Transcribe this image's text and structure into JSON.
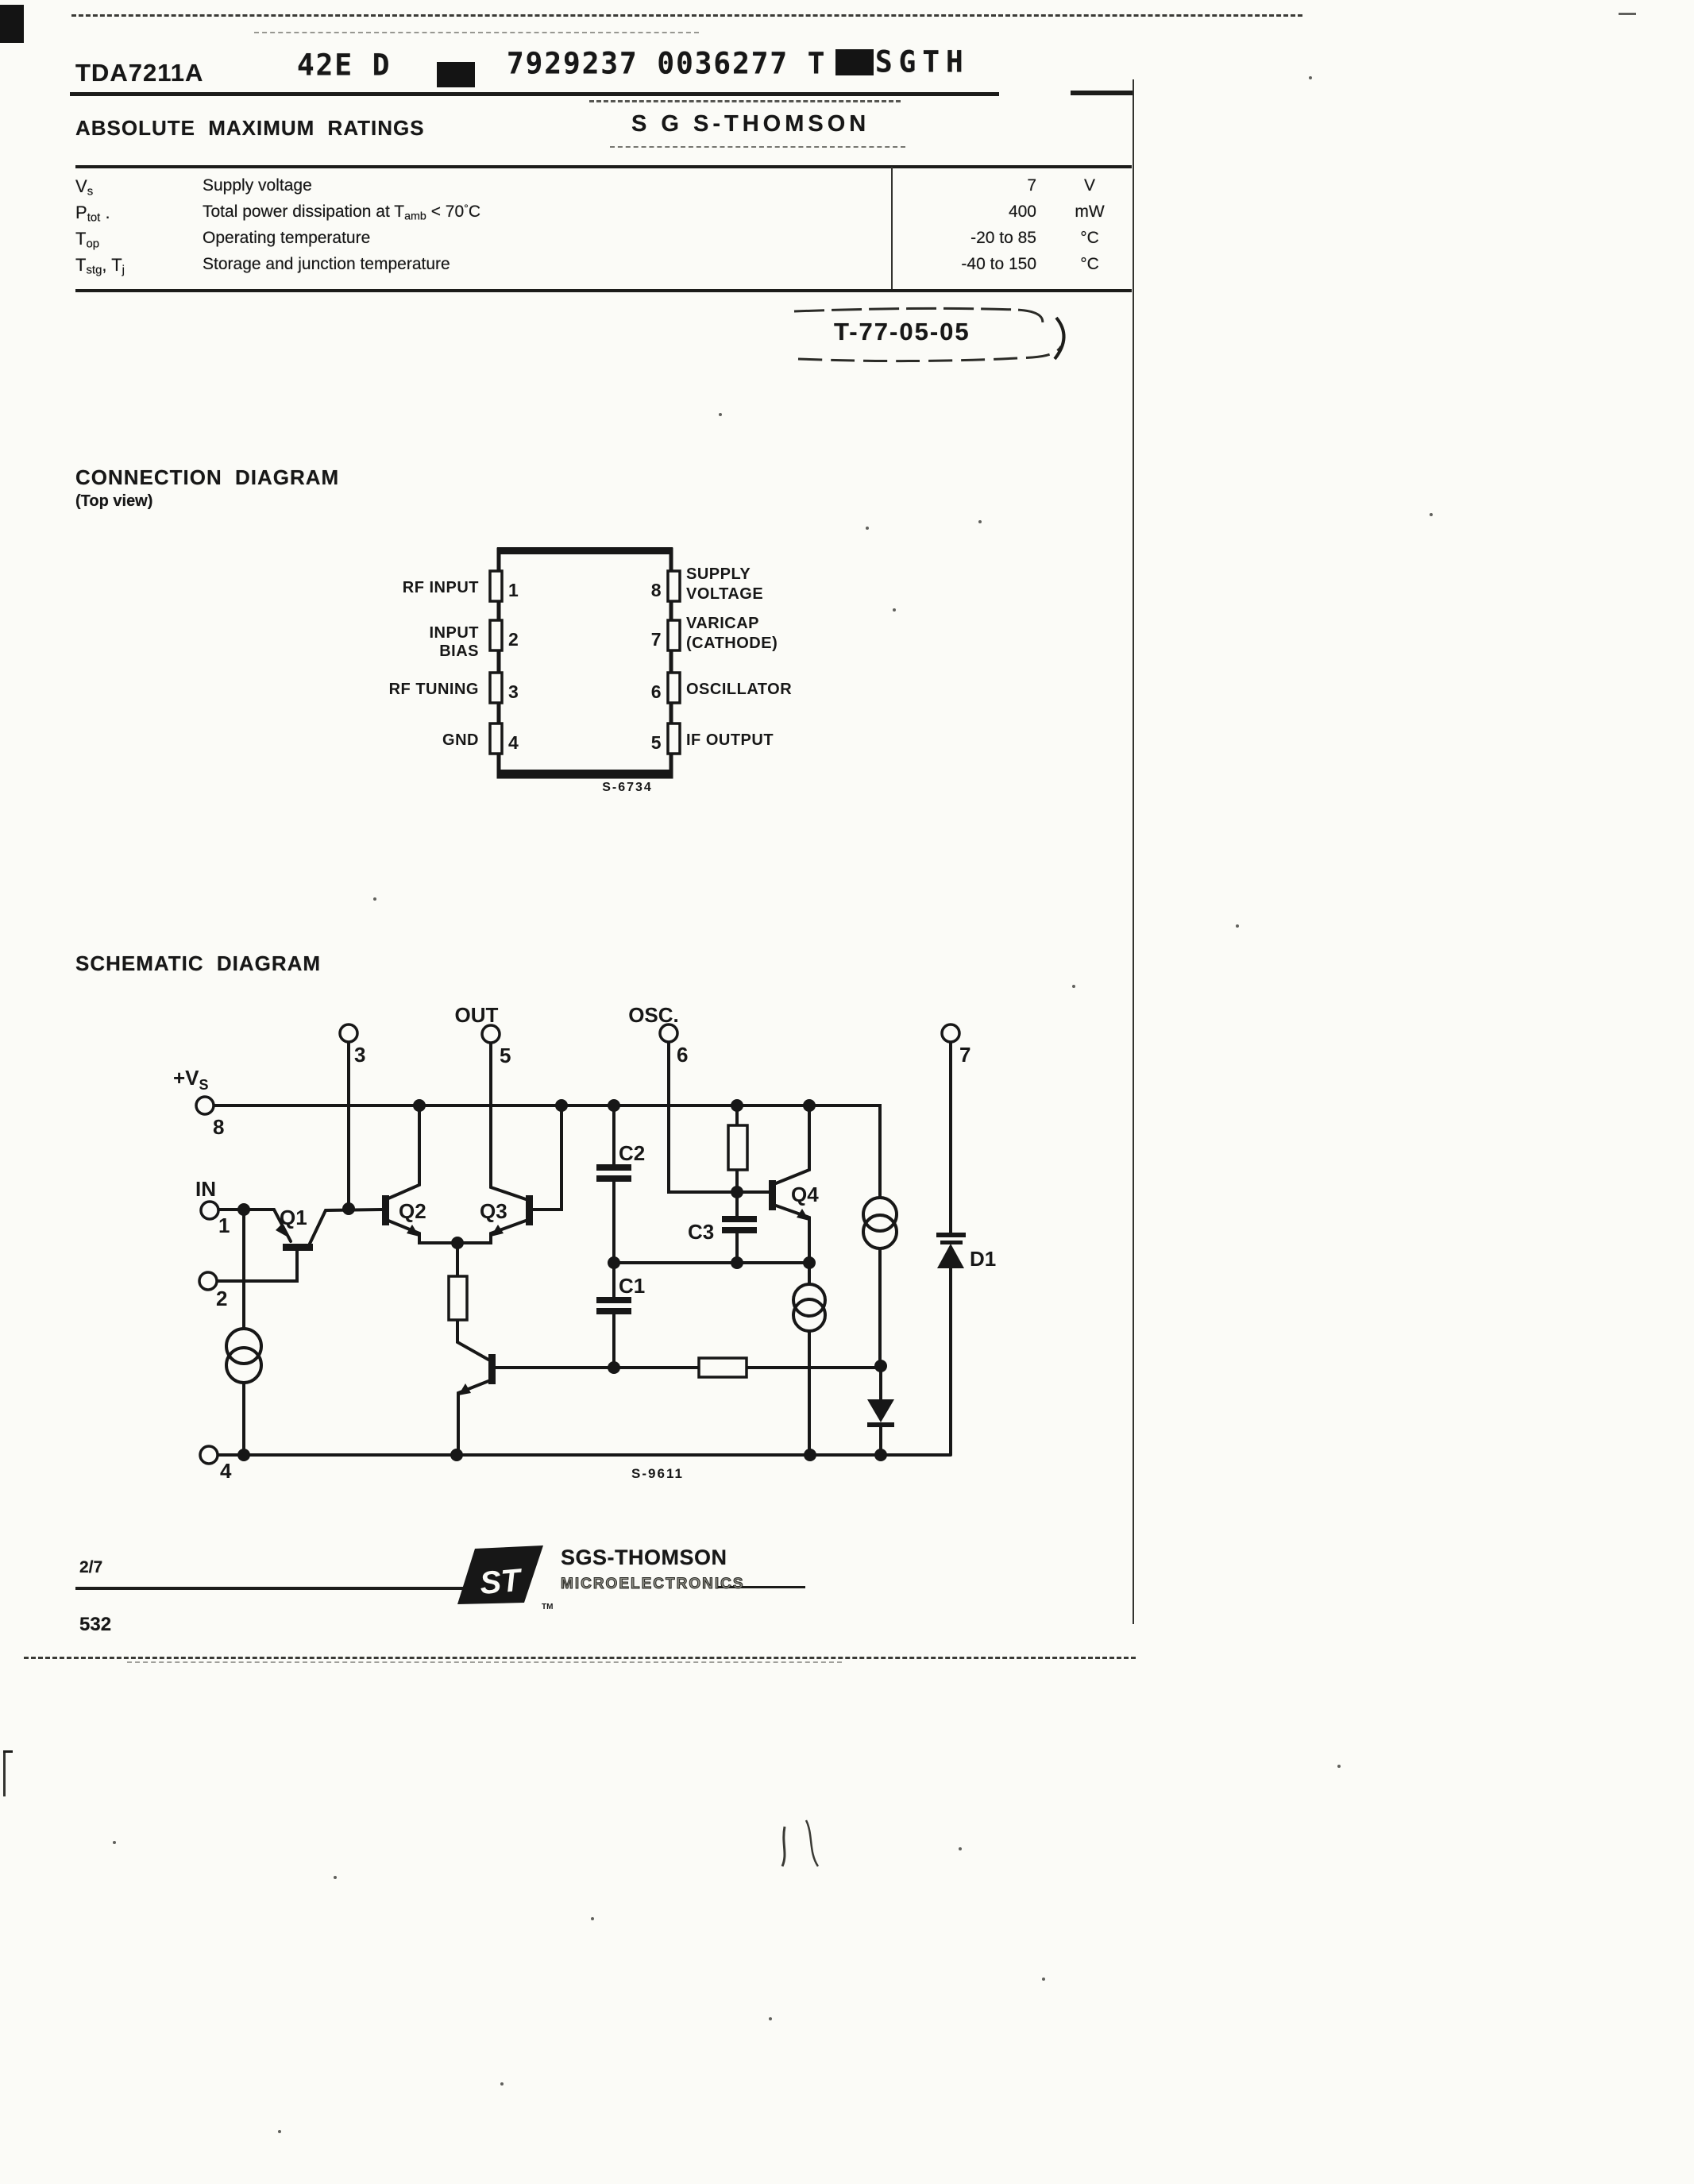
{
  "header": {
    "part": "TDA7211A",
    "code": "42E D",
    "serial": "7929237 0036277 T",
    "suffix": "SGTH"
  },
  "stamps": {
    "sgs": "S G S-THOMSON",
    "t77": "T-77-05-05"
  },
  "ratings": {
    "title": "ABSOLUTE MAXIMUM RATINGS",
    "rows": [
      {
        "sym": [
          {
            "t": "V"
          },
          {
            "t": "s",
            "sub": true
          }
        ],
        "desc": [
          {
            "t": "Supply voltage"
          }
        ],
        "value": "7",
        "unit": "V"
      },
      {
        "sym": [
          {
            "t": "P"
          },
          {
            "t": "tot",
            "sub": true
          },
          {
            "t": " ."
          }
        ],
        "desc": [
          {
            "t": "Total power dissipation at T"
          },
          {
            "t": "amb",
            "sub": true
          },
          {
            "t": " < 70"
          },
          {
            "t": "°",
            "sup": true
          },
          {
            "t": "C"
          }
        ],
        "value": "400",
        "unit": "mW"
      },
      {
        "sym": [
          {
            "t": "T"
          },
          {
            "t": "op",
            "sub": true
          }
        ],
        "desc": [
          {
            "t": "Operating temperature"
          }
        ],
        "value": "-20 to 85",
        "unit": "°C"
      },
      {
        "sym": [
          {
            "t": "T"
          },
          {
            "t": "stg",
            "sub": true
          },
          {
            "t": ", T"
          },
          {
            "t": "j",
            "sub": true
          }
        ],
        "desc": [
          {
            "t": "Storage and junction temperature"
          }
        ],
        "value": "-40 to 150",
        "unit": "°C"
      }
    ]
  },
  "connection": {
    "title": "CONNECTION DIAGRAM",
    "subtitle": "(Top view)",
    "code": "S-6734",
    "left_pins": [
      {
        "num": "1",
        "lines": [
          "RF INPUT"
        ]
      },
      {
        "num": "2",
        "lines": [
          "INPUT",
          "BIAS"
        ]
      },
      {
        "num": "3",
        "lines": [
          "RF TUNING"
        ]
      },
      {
        "num": "4",
        "lines": [
          "GND"
        ]
      }
    ],
    "right_pins": [
      {
        "num": "8",
        "lines": [
          "SUPPLY",
          "VOLTAGE"
        ]
      },
      {
        "num": "7",
        "lines": [
          "VARICAP",
          "(CATHODE)"
        ]
      },
      {
        "num": "6",
        "lines": [
          "OSCILLATOR"
        ]
      },
      {
        "num": "5",
        "lines": [
          "IF OUTPUT"
        ]
      }
    ]
  },
  "schematic": {
    "title": "SCHEMATIC DIAGRAM",
    "code": "S-9611",
    "labels": {
      "out": "OUT",
      "osc": "OSC.",
      "vs": "+V",
      "vs_sub": "S",
      "in": "IN",
      "p1": "1",
      "p2": "2",
      "p3": "3",
      "p4": "4",
      "p5": "5",
      "p6": "6",
      "p7": "7",
      "p8": "8",
      "q1": "Q1",
      "q2": "Q2",
      "q3": "Q3",
      "q4": "Q4",
      "c1": "C1",
      "c2": "C2",
      "c3": "C3",
      "d1": "D1"
    }
  },
  "footer": {
    "page": "2/7",
    "number": "532",
    "brand": "SGS-THOMSON",
    "brand2": "MICROELECTRONICS",
    "tm": "TM"
  }
}
